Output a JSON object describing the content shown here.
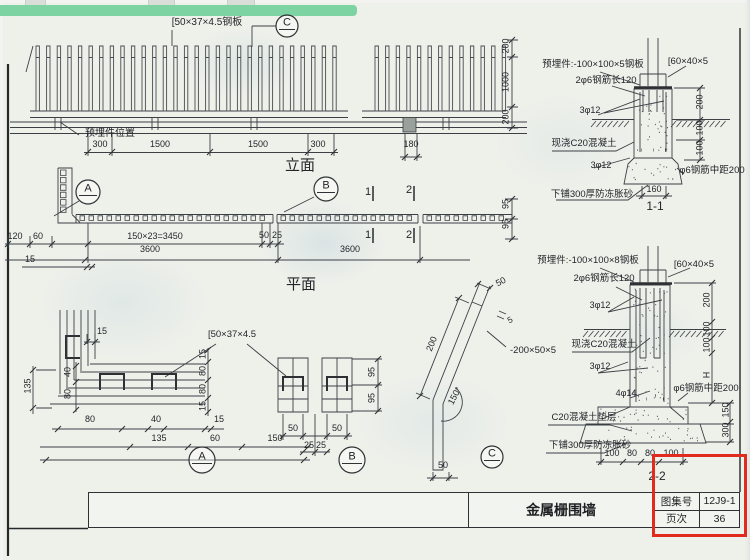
{
  "meta": {
    "sheet_title": "金属栅围墙",
    "atlas_label": "图集号",
    "atlas_no": "12J9-1",
    "page_label": "页次",
    "page_no": "36"
  },
  "colors": {
    "accent_green": "#7ed3a2",
    "highlight_red": "#e02b1e",
    "line": "#3b4045",
    "paper": "#eef0ea"
  },
  "bubbles": [
    {
      "letter": "C",
      "x": 287,
      "y": 26,
      "r": 11,
      "n": "detail-bubble-c-top"
    },
    {
      "letter": "A",
      "x": 88,
      "y": 192,
      "r": 12,
      "n": "detail-bubble-a-plan"
    },
    {
      "letter": "B",
      "x": 326,
      "y": 189,
      "r": 12,
      "n": "detail-bubble-b-plan"
    },
    {
      "letter": "A",
      "x": 202,
      "y": 460,
      "r": 13,
      "n": "detail-bubble-a"
    },
    {
      "letter": "B",
      "x": 352,
      "y": 460,
      "r": 13,
      "n": "detail-bubble-b"
    },
    {
      "letter": "C",
      "x": 492,
      "y": 457,
      "r": 11,
      "n": "detail-bubble-c"
    }
  ],
  "annotations": [
    {
      "t": "[50×37×4.5钢板",
      "x": 207,
      "y": 18,
      "s": 10,
      "n": "label-channel-steel-top"
    },
    {
      "t": "预埋件位置",
      "x": 110,
      "y": 129,
      "s": 10,
      "n": "label-embed-position"
    },
    {
      "t": "300",
      "x": 100,
      "y": 140
    },
    {
      "t": "1500",
      "x": 160,
      "y": 140
    },
    {
      "t": "1500",
      "x": 258,
      "y": 140
    },
    {
      "t": "300",
      "x": 318,
      "y": 140
    },
    {
      "t": "180",
      "x": 411,
      "y": 140
    },
    {
      "t": "立面",
      "x": 300,
      "y": 158,
      "s": 15,
      "n": "elevation-title"
    },
    {
      "t": "200",
      "x": 506,
      "y": 46,
      "r": -90
    },
    {
      "t": "1000",
      "x": 506,
      "y": 82,
      "r": -90
    },
    {
      "t": "200",
      "x": 506,
      "y": 117,
      "r": -90
    },
    {
      "t": "预埋件:-100×100×5钢板",
      "x": 593,
      "y": 60,
      "s": 9.5,
      "n": "label-embed-plate-1-1"
    },
    {
      "t": "[60×40×5",
      "x": 688,
      "y": 57,
      "s": 9.5
    },
    {
      "t": "2φ6钢筋长120",
      "x": 606,
      "y": 76,
      "s": 9.5
    },
    {
      "t": "3φ12",
      "x": 590,
      "y": 106
    },
    {
      "t": "现浇C20混凝土",
      "x": 584,
      "y": 139,
      "s": 9.5
    },
    {
      "t": "3φ12",
      "x": 601,
      "y": 161
    },
    {
      "t": "φ6钢筋中距200",
      "x": 712,
      "y": 166,
      "s": 9.5
    },
    {
      "t": "下铺300厚防冻胀砂",
      "x": 592,
      "y": 190,
      "s": 9.5
    },
    {
      "t": "160",
      "x": 654,
      "y": 185
    },
    {
      "t": "1-1",
      "x": 655,
      "y": 200,
      "s": 12,
      "n": "section-1-1-label"
    },
    {
      "t": "200",
      "x": 700,
      "y": 102,
      "r": -90
    },
    {
      "t": "100",
      "x": 700,
      "y": 128,
      "r": -90
    },
    {
      "t": "100",
      "x": 700,
      "y": 148,
      "r": -90
    },
    {
      "t": "150×23=3450",
      "x": 155,
      "y": 232
    },
    {
      "t": "50",
      "x": 264,
      "y": 231
    },
    {
      "t": "25",
      "x": 277,
      "y": 231
    },
    {
      "t": "3600",
      "x": 150,
      "y": 245
    },
    {
      "t": "3600",
      "x": 350,
      "y": 245
    },
    {
      "t": "120",
      "x": 15,
      "y": 232
    },
    {
      "t": "60",
      "x": 38,
      "y": 232
    },
    {
      "t": "15",
      "x": 30,
      "y": 255
    },
    {
      "t": "95",
      "x": 506,
      "y": 204,
      "r": -90
    },
    {
      "t": "95",
      "x": 506,
      "y": 224,
      "r": -90
    },
    {
      "t": "1",
      "x": 368,
      "y": 187,
      "s": 11
    },
    {
      "t": "1",
      "x": 368,
      "y": 230,
      "s": 11
    },
    {
      "t": "2",
      "x": 409,
      "y": 185,
      "s": 11
    },
    {
      "t": "2",
      "x": 409,
      "y": 230,
      "s": 11
    },
    {
      "t": "平面",
      "x": 301,
      "y": 277,
      "s": 15,
      "n": "plan-title"
    },
    {
      "t": "预埋件:-100×100×8钢板",
      "x": 588,
      "y": 256,
      "s": 9.5,
      "n": "label-embed-plate-2-2"
    },
    {
      "t": "2φ6钢筋长120",
      "x": 604,
      "y": 274,
      "s": 9.5
    },
    {
      "t": "[60×40×5",
      "x": 694,
      "y": 260,
      "s": 9.5
    },
    {
      "t": "3φ12",
      "x": 600,
      "y": 301
    },
    {
      "t": "现浇C20混凝土",
      "x": 604,
      "y": 340,
      "s": 9.5
    },
    {
      "t": "3φ12",
      "x": 600,
      "y": 362
    },
    {
      "t": "4φ14",
      "x": 626,
      "y": 389
    },
    {
      "t": "φ6钢筋中距200",
      "x": 706,
      "y": 384,
      "s": 9.5
    },
    {
      "t": "C20混凝土垫层",
      "x": 584,
      "y": 413,
      "s": 9.5
    },
    {
      "t": "下铺300厚防冻胀砂",
      "x": 590,
      "y": 441,
      "s": 9.5
    },
    {
      "t": "100",
      "x": 612,
      "y": 449
    },
    {
      "t": "80",
      "x": 632,
      "y": 449
    },
    {
      "t": "80",
      "x": 650,
      "y": 449
    },
    {
      "t": "100",
      "x": 671,
      "y": 449
    },
    {
      "t": "2-2",
      "x": 657,
      "y": 470,
      "s": 12,
      "n": "section-2-2-label"
    },
    {
      "t": "200",
      "x": 707,
      "y": 300,
      "r": -90
    },
    {
      "t": "100",
      "x": 707,
      "y": 329,
      "r": -90
    },
    {
      "t": "100",
      "x": 707,
      "y": 345,
      "r": -90
    },
    {
      "t": "H",
      "x": 707,
      "y": 375,
      "r": -90
    },
    {
      "t": "150",
      "x": 726,
      "y": 410,
      "r": -90
    },
    {
      "t": "300",
      "x": 726,
      "y": 430,
      "r": -90
    },
    {
      "t": "15",
      "x": 102,
      "y": 327
    },
    {
      "t": "135",
      "x": 28,
      "y": 386,
      "r": -90
    },
    {
      "t": "40",
      "x": 68,
      "y": 372,
      "r": -90
    },
    {
      "t": "80",
      "x": 68,
      "y": 394,
      "r": -90
    },
    {
      "t": "80",
      "x": 90,
      "y": 415
    },
    {
      "t": "40",
      "x": 156,
      "y": 415
    },
    {
      "t": "15",
      "x": 219,
      "y": 415
    },
    {
      "t": "135",
      "x": 159,
      "y": 434
    },
    {
      "t": "60",
      "x": 215,
      "y": 434
    },
    {
      "t": "150",
      "x": 275,
      "y": 434
    },
    {
      "t": "15",
      "x": 203,
      "y": 354,
      "r": -90
    },
    {
      "t": "80",
      "x": 203,
      "y": 371,
      "r": -90
    },
    {
      "t": "80",
      "x": 203,
      "y": 389,
      "r": -90
    },
    {
      "t": "15",
      "x": 203,
      "y": 406,
      "r": -90
    },
    {
      "t": "[50×37×4.5",
      "x": 232,
      "y": 330,
      "s": 9.5,
      "n": "label-channel-steel-detail"
    },
    {
      "t": "95",
      "x": 372,
      "y": 372,
      "r": -90
    },
    {
      "t": "95",
      "x": 372,
      "y": 398,
      "r": -90
    },
    {
      "t": "50",
      "x": 293,
      "y": 424
    },
    {
      "t": "50",
      "x": 337,
      "y": 424
    },
    {
      "t": "25",
      "x": 309,
      "y": 441
    },
    {
      "t": "25",
      "x": 321,
      "y": 441
    },
    {
      "t": "200",
      "x": 432,
      "y": 344,
      "r": -68
    },
    {
      "t": "50",
      "x": 501,
      "y": 282,
      "r": -28
    },
    {
      "t": "5",
      "x": 510,
      "y": 320,
      "s": 8.5,
      "r": -28
    },
    {
      "t": "-200×50×5",
      "x": 533,
      "y": 346,
      "s": 9.5,
      "n": "label-bent-plate"
    },
    {
      "t": "150°",
      "x": 455,
      "y": 396,
      "r": -62
    },
    {
      "t": "50",
      "x": 443,
      "y": 461
    }
  ]
}
